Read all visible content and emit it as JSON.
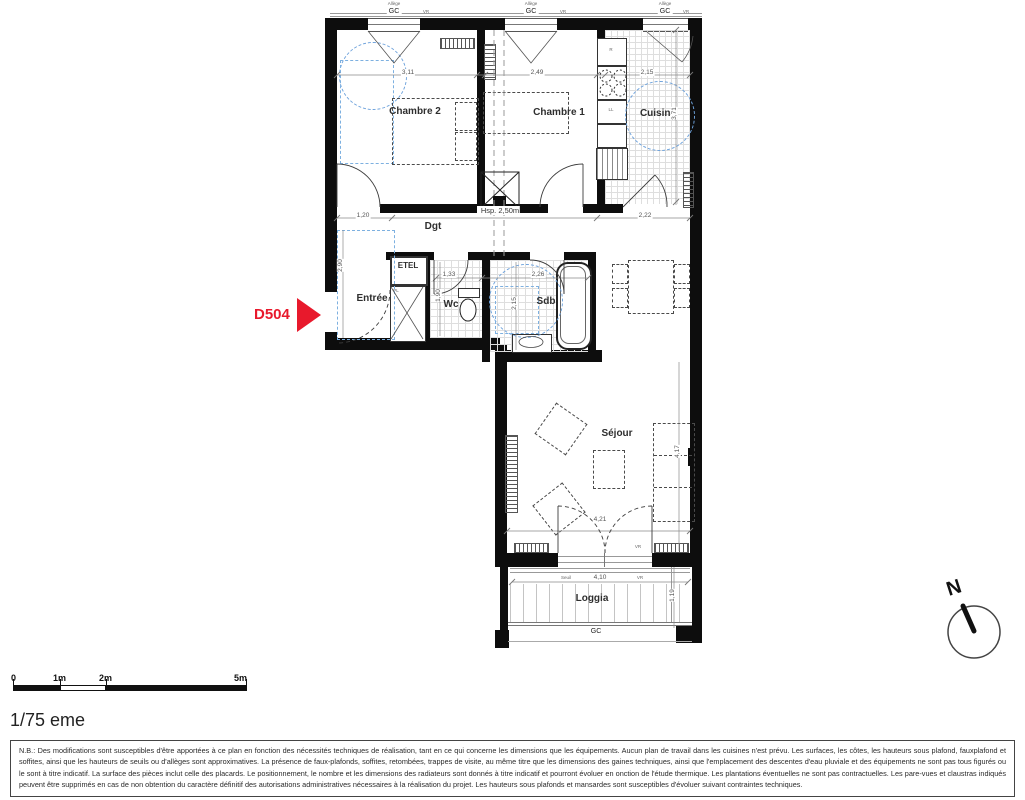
{
  "plan": {
    "unit": "D504",
    "rooms": {
      "chambre2": "Chambre 2",
      "chambre1": "Chambre 1",
      "cuisine": "Cuisine",
      "dgt": "Dgt",
      "entree": "Entrée",
      "wc": "Wc",
      "sdb": "Sdb",
      "sejour": "Séjour",
      "loggia": "Loggia",
      "etel": "ETEL",
      "pl": "PL"
    },
    "labels": {
      "gc": "GC",
      "allege": "Allège",
      "vr": "VR",
      "seuil": "Seuil",
      "hsp": "Hsp. 2,50m",
      "fridge": "R",
      "washer": "LL",
      "north": "N"
    },
    "dimensions": {
      "chambre2_width": "3,11",
      "chambre1_width": "2,49",
      "cuisine_width": "2,15",
      "cuisine_depth": "3,71",
      "degagement_left": "1,20",
      "degagement_right": "2,22",
      "wc_width": "1,33",
      "wc_depth": "1,90",
      "sdb_width": "2,26",
      "sdb_depth": "2,15",
      "entree_depth": "2,90",
      "sejour_width": "4,21",
      "sejour_depth": "4,17",
      "loggia_width": "4,10",
      "loggia_depth": "1,19"
    }
  },
  "scale_bar": {
    "t0": "0",
    "t1": "1m",
    "t2": "2m",
    "t5": "5m"
  },
  "scale_text": "1/75 eme",
  "note": {
    "text": "N.B.: Des modifications sont susceptibles d'être apportées à ce plan en fonction des nécessités techniques de réalisation, tant en ce qui concerne les dimensions que les équipements. Aucun plan de travail dans les cuisines n'est prévu. Les surfaces, les côtes, les hauteurs sous plafond, fauxplafond et soffites, ainsi que les hauteurs de seuils ou d'allèges sont approximatives. La présence de faux-plafonds, soffites, retombées, trappes de visite, au même titre que les dimensions des gaines techniques, ainsi que l'emplacement des descentes d'eau pluviale et des équipements ne sont pas tous figurés ou le sont à titre indicatif. La surface des pièces inclut celle des placards. Le positionnement, le nombre et les dimensions des radiateurs sont donnés à titre indicatif et pourront évoluer en onction de l'étude thermique. Les plantations éventuelles ne sont pas contractuelles. Les pare-vues et claustras indiqués peuvent être supprimés en cas de non obtention du caractère définitif des autorisations administratives nécessaires à la réalisation du projet. Les hauteurs sous plafonds et mansardes sont susceptibles d'évoluer suivant contraintes techniques."
  },
  "colors": {
    "accent_red": "#e8192c",
    "blue_dash": "#6fa3dc",
    "wall": "#0d0d0d"
  }
}
